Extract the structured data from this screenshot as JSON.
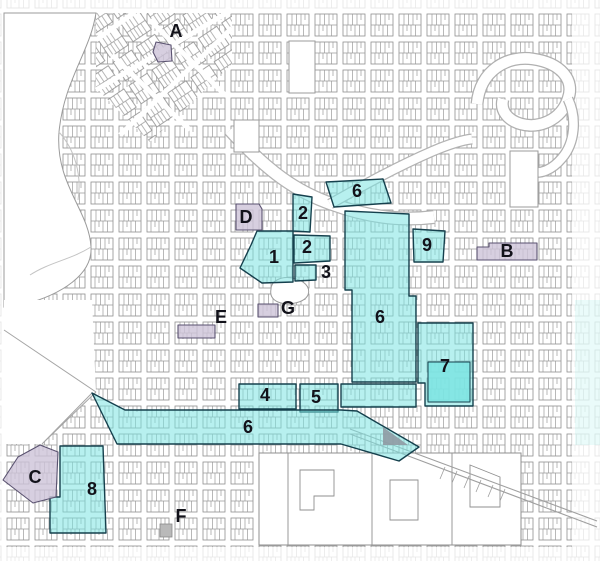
{
  "map": {
    "kind": "city-parcel-district-map",
    "colors": {
      "district_fill": "#7ce4e2",
      "district_border": "#15404d",
      "site_fill": "#cdc3d8",
      "site_border": "#5a5270",
      "label": "#12121a",
      "street": "#ffffff",
      "parcel_line": "#8f8f8f"
    },
    "labels": [
      {
        "text": "A",
        "x": 176,
        "y": 31,
        "kind": "site"
      },
      {
        "text": "B",
        "x": 507,
        "y": 251,
        "kind": "site"
      },
      {
        "text": "C",
        "x": 35,
        "y": 477,
        "kind": "site"
      },
      {
        "text": "D",
        "x": 246,
        "y": 217,
        "kind": "site"
      },
      {
        "text": "E",
        "x": 221,
        "y": 317,
        "kind": "plain"
      },
      {
        "text": "F",
        "x": 181,
        "y": 516,
        "kind": "plain"
      },
      {
        "text": "G",
        "x": 288,
        "y": 308,
        "kind": "plain"
      },
      {
        "text": "1",
        "x": 274,
        "y": 257,
        "kind": "district"
      },
      {
        "text": "2",
        "x": 303,
        "y": 213,
        "kind": "district"
      },
      {
        "text": "2",
        "x": 307,
        "y": 247,
        "kind": "district"
      },
      {
        "text": "3",
        "x": 326,
        "y": 272,
        "kind": "district"
      },
      {
        "text": "4",
        "x": 265,
        "y": 395,
        "kind": "district"
      },
      {
        "text": "5",
        "x": 316,
        "y": 397,
        "kind": "district"
      },
      {
        "text": "6",
        "x": 357,
        "y": 191,
        "kind": "district"
      },
      {
        "text": "6",
        "x": 380,
        "y": 317,
        "kind": "district"
      },
      {
        "text": "6",
        "x": 248,
        "y": 427,
        "kind": "district"
      },
      {
        "text": "7",
        "x": 445,
        "y": 366,
        "kind": "district"
      },
      {
        "text": "8",
        "x": 92,
        "y": 489,
        "kind": "district"
      },
      {
        "text": "9",
        "x": 427,
        "y": 245,
        "kind": "district"
      }
    ]
  }
}
